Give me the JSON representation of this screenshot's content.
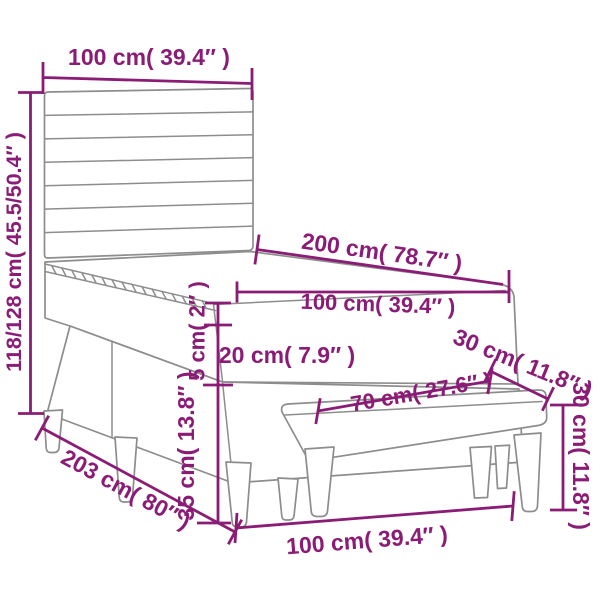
{
  "figure": {
    "kind": "product-dimension-diagram",
    "subject": "box spring bed with slatted headboard, mattress, topper and bench",
    "background": "#ffffff"
  },
  "colors": {
    "dimension_accent": "#8B1C75",
    "artwork_line": "#8d8d8d"
  },
  "labels": {
    "headboard_width": "100 cm( 39.4″ )",
    "overall_height": "118/128 cm( 45.5/50.4″ )",
    "mattress_length": "200 cm( 78.7″ )",
    "mattress_width": "100 cm( 39.4″ )",
    "topper_thickness": "5 cm( 2″ )",
    "mattress_thickness": "20 cm( 7.9″ )",
    "base_height": "35 cm( 13.8″ )",
    "overall_length": "203 cm( 80″ )",
    "overall_width": "100 cm( 39.4″ )",
    "bench_depth_top": "30 cm( 11.8″ )",
    "bench_length": "70 cm( 27.6″ )",
    "bench_height": "30 cm( 11.8″ )"
  }
}
